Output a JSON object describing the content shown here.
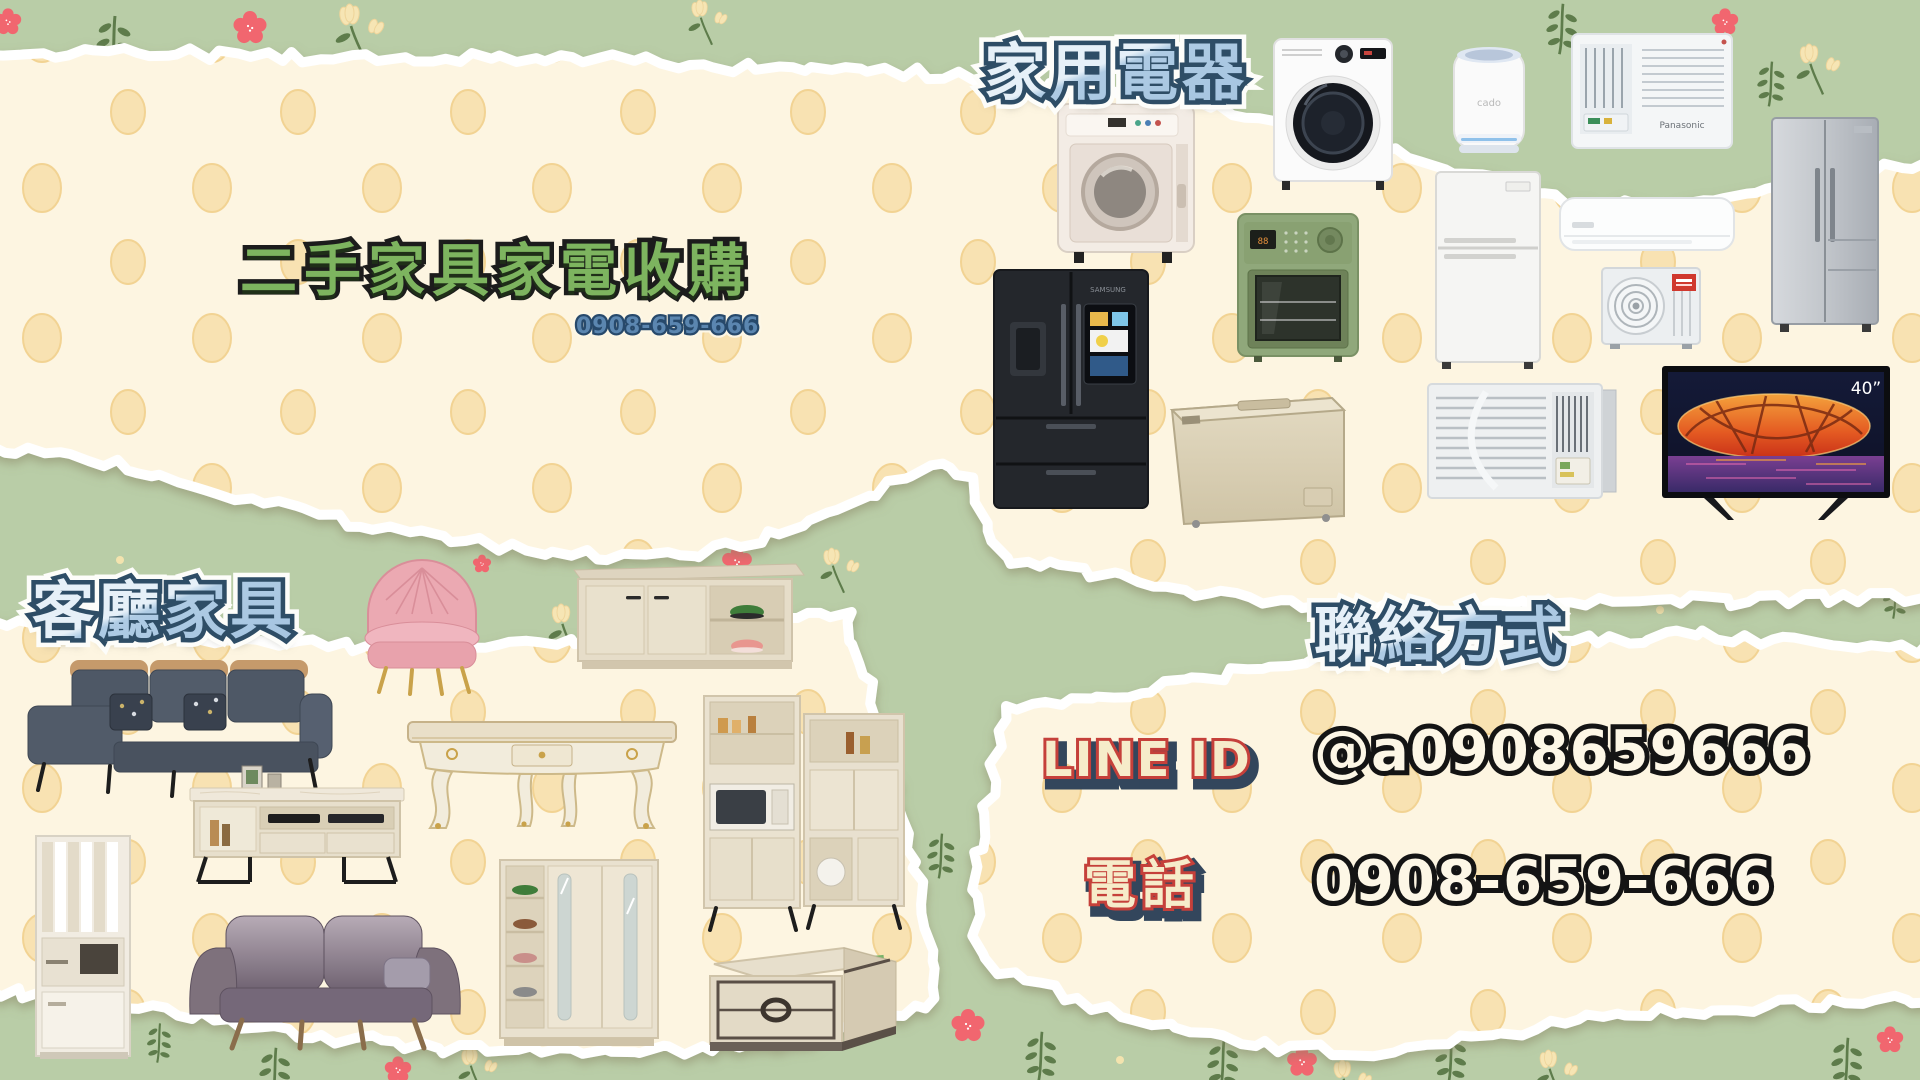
{
  "poster": {
    "title": "二手家具家電收購",
    "title_phone": "0908-659-666",
    "appliances": {
      "header": "家用電器",
      "tv_size_label": "40”",
      "purifier_brand": "cado",
      "window_ac_brand": "Panasonic",
      "items": [
        "clothes-dryer",
        "washer-dryer",
        "air-purifier",
        "window-air-conditioner-panasonic",
        "side-by-side-refrigerator",
        "french-door-refrigerator-black",
        "countertop-oven-green",
        "top-freezer-refrigerator",
        "split-ac-indoor-unit",
        "ac-outdoor-unit",
        "chest-freezer",
        "window-air-conditioner-teco",
        "flat-screen-tv-40"
      ]
    },
    "furniture": {
      "header": "客廳家具",
      "items": [
        "pink-velvet-armchair",
        "shoe-bench",
        "sectional-sofa",
        "ornate-coffee-table",
        "kitchen-hutch",
        "room-divider-cabinet",
        "tv-stand",
        "loveseat-sofa",
        "sliding-door-shoe-cabinet",
        "storage-coffee-table"
      ]
    },
    "contact": {
      "header": "聯絡方式",
      "line_id_label": "LINE ID",
      "line_id_value": "@a0908659666",
      "phone_label": "電話",
      "phone_value": "0908-659-666"
    },
    "colors": {
      "background_green": "#b9cda7",
      "panel_cream": "#fdf5e1",
      "polka_dot": "#f8e2b2",
      "header_blue_fill": "#aecbe4",
      "header_outline_navy": "#2e4d66",
      "title_green": "#7db45f",
      "flower_coral": "#f1666f",
      "leaf_green": "#5e7c4b",
      "phone_blue": "#5b86b0",
      "label_red": "#c5403a",
      "label_cream": "#f6ecca"
    }
  }
}
